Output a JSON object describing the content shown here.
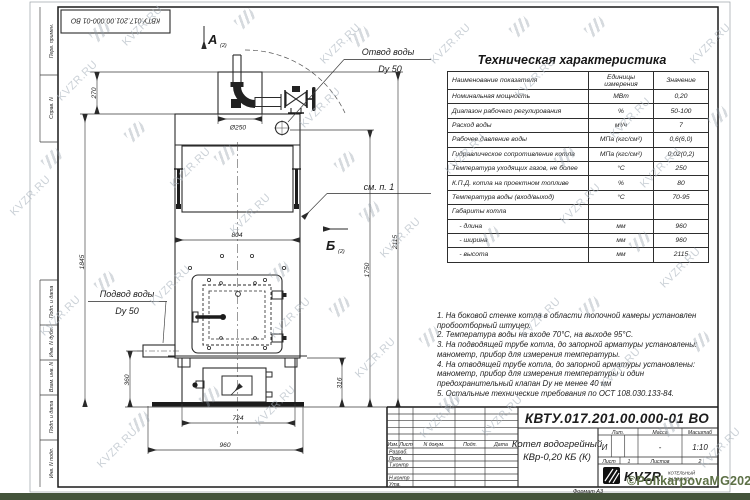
{
  "watermark": {
    "tile": "KVZR.RU",
    "credit": "©PolikarpovaMG2021"
  },
  "stamp_top": {
    "code": "КВТУ.017.201.00.000-01 ВО"
  },
  "margin": {
    "labels": [
      "Перв. примен.",
      "Справ. N",
      "Подп. и дата",
      "Инв. N дубл.",
      "Взам. инв. N",
      "Подп. и дата",
      "Инв. N подл."
    ]
  },
  "drawing": {
    "view_a": "А",
    "view_a_sub": "(2)",
    "view_b": "Б",
    "view_b_sub": "(2)",
    "see_note": "см. п. 1",
    "outlet_label": "Отвод воды",
    "outlet_dn": "Dy 50",
    "inlet_label": "Подвод воды",
    "inlet_dn": "Dy 50",
    "flue_dia": "Ø250",
    "dims": {
      "d270": "270",
      "d1845": "1845",
      "d804": "804",
      "d360": "360",
      "d316": "316",
      "d724": "724",
      "d960": "960",
      "d1750": "1750",
      "d2115": "2115"
    }
  },
  "spec": {
    "title": "Техническая характеристика",
    "headers": [
      "Наименование показателя",
      "Единицы измерения",
      "Значение"
    ],
    "rows": [
      [
        "Номинальная мощность",
        "МВт",
        "0,20"
      ],
      [
        "Диапазон рабочего регулирования",
        "%",
        "50-100"
      ],
      [
        "Расход воды",
        "м³/ч",
        "7"
      ],
      [
        "Рабочее давление воды",
        "МПа (кгс/см²)",
        "0,6(6,0)"
      ],
      [
        "Гидравлическое сопротивление котла",
        "МПа (кгс/см²)",
        "0,02(0,2)"
      ],
      [
        "Температура уходящих газов, не более",
        "°С",
        "250"
      ],
      [
        "К.П.Д. котла на проектном топливе",
        "%",
        "80"
      ],
      [
        "Температура воды (вход/выход)",
        "°С",
        "70-95"
      ],
      [
        "Габариты котла",
        "",
        ""
      ],
      [
        "    - длина",
        "мм",
        "960"
      ],
      [
        "    - ширина",
        "мм",
        "960"
      ],
      [
        "    - высота",
        "мм",
        "2115"
      ]
    ]
  },
  "notes": [
    "1. На боковой стенке котла в области топочной камеры установлен пробоотборный штуцер.",
    "2. Температура воды на входе 70°С, на выходе 95°С.",
    "3. На подводящей трубе котла, до запорной арматуры установлены: манометр, прибор для измерения температуры.",
    "4. На отводящей трубе котла, до запорной арматуры установлены: манометр, прибор для измерения температуры и один предохранительный клапан Dу не менее 40 мм",
    "5. Остальные технические требования по ОСТ 108.030.133-84."
  ],
  "title_block": {
    "doc_number": "КВТУ.017.201.00.000-01 ВО",
    "product_line1": "Котел водогрейный",
    "product_line2": "КВр-0,20 КБ (К)",
    "lit_label": "Лит.",
    "mass_label": "Масса",
    "scale_label": "Масштаб",
    "lit_value": "И",
    "mass_value": "-",
    "scale_value": "1:10",
    "sheet_label": "Лист",
    "sheet_value": "1",
    "sheets_label": "Листов",
    "sheets_value": "2",
    "header_cols": [
      "Изм.",
      "Лист",
      "N докум.",
      "Подп.",
      "Дата"
    ],
    "sig_rows": [
      "Разраб.",
      "Пров.",
      "Т.контр",
      "Н.контр",
      "Утв."
    ],
    "logo_text": "KVZR",
    "logo_sub1": "КОТЕЛЬНЫЙ",
    "logo_sub2": "ЗАВОД РЭП",
    "format_label": "Формат А3"
  }
}
